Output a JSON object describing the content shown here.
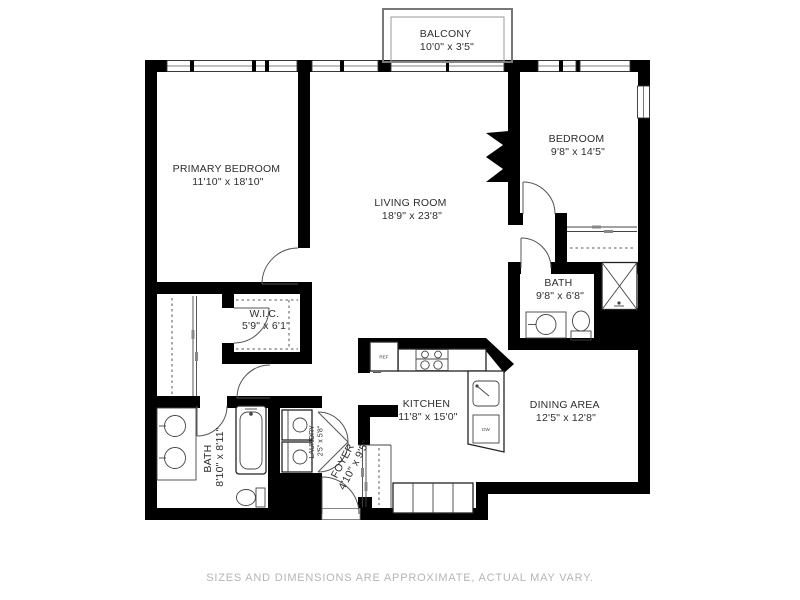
{
  "plan": {
    "type": "residential floor plan",
    "rooms": {
      "balcony": {
        "name": "BALCONY",
        "dims": "10'0\" x 3'5\""
      },
      "primary_bedroom": {
        "name": "PRIMARY BEDROOM",
        "dims": "11'10\" x 18'10\""
      },
      "living_room": {
        "name": "LIVING ROOM",
        "dims": "18'9\" x 23'8\""
      },
      "bedroom": {
        "name": "BEDROOM",
        "dims": "9'8\" x 14'5\""
      },
      "bath_upper": {
        "name": "BATH",
        "dims": "9'8\" x 6'8\""
      },
      "wic": {
        "name": "W.I.C.",
        "dims": "5'9\" x 6'1\""
      },
      "kitchen": {
        "name": "KITCHEN",
        "dims": "11'8\" x 15'0\""
      },
      "dining_area": {
        "name": "DINING AREA",
        "dims": "12'5\" x 12'8\""
      },
      "bath_lower": {
        "name": "BATH",
        "dims": "8'10\" x 8'11\""
      },
      "laundry": {
        "name": "LAUNDRY",
        "dims": "2'5\" x 5'8\""
      },
      "foyer": {
        "name": "FOYER",
        "dims": "4'10\" x 9'5\""
      }
    },
    "fixtures": {
      "refrigerator": "REF",
      "dishwasher": "DW"
    },
    "disclaimer": "SIZES AND DIMENSIONS ARE APPROXIMATE, ACTUAL MAY VARY.",
    "colors": {
      "wall": "#000000",
      "label_text": "#2e2e2e",
      "disclaimer_text": "#b5b5b5",
      "background": "#ffffff"
    }
  }
}
